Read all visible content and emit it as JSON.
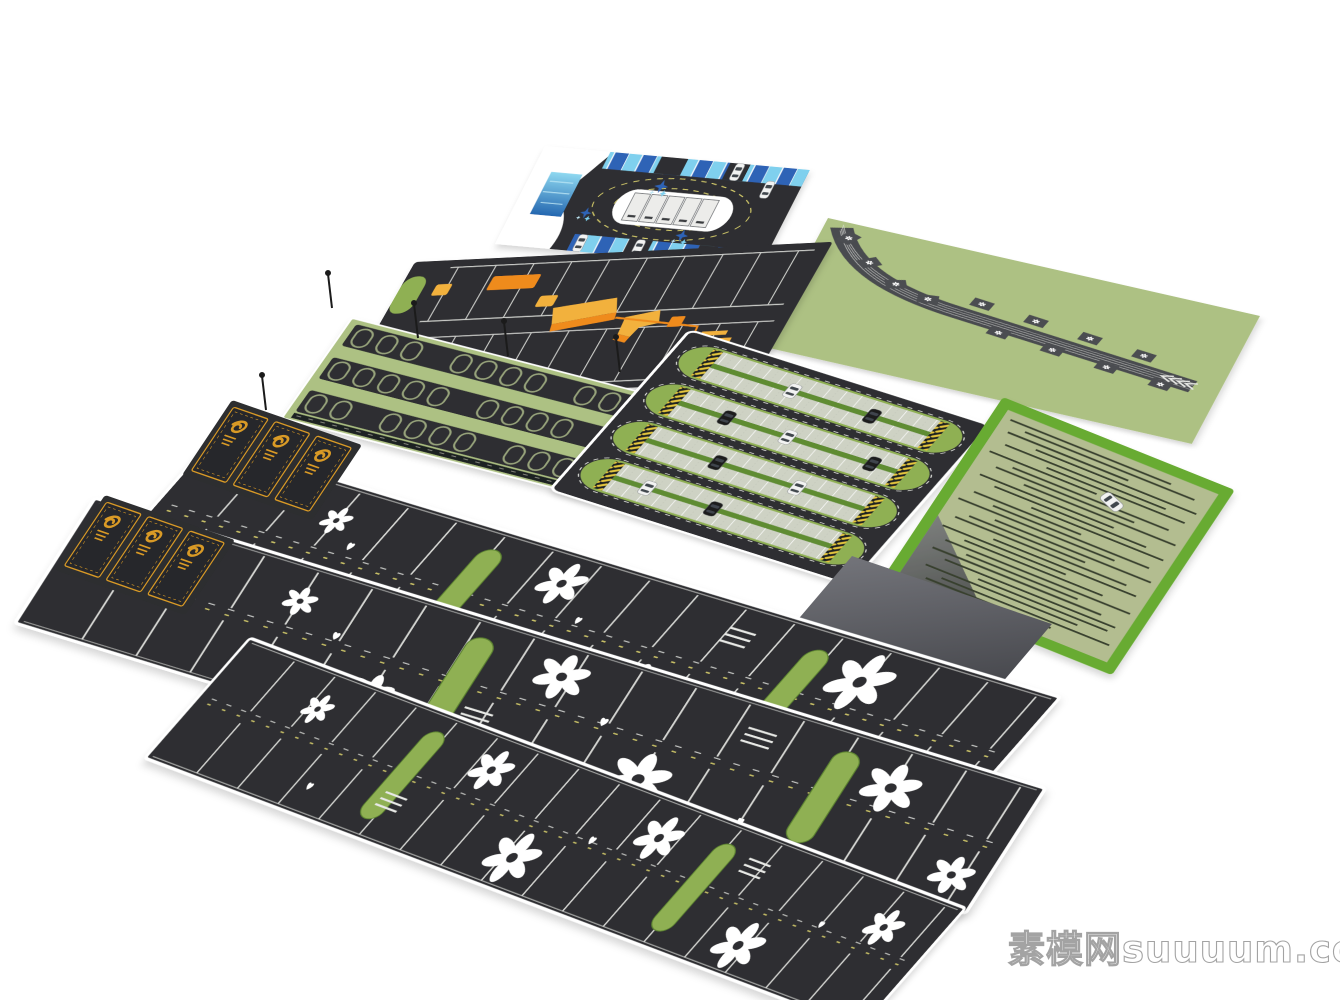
{
  "watermark": {
    "text": "素模网suuuum.com"
  },
  "palette": {
    "background": "#ffffff",
    "asphalt": "#2d2e30",
    "asphalt_deep": "#1f2022",
    "white": "#ffffff",
    "line_white": "#e8e9e6",
    "lawn": "#adc183",
    "lawn_bright": "#67ab33",
    "island_green": "#8fb052",
    "stall_gray": "#ced2c4",
    "blue_light": "#7fd0ee",
    "blue_dark": "#2e63b6",
    "orange": "#ef8b1e",
    "amber": "#f2b13d",
    "gold": "#d99a26",
    "road_gray": "#4c4d51",
    "paver_sage": "#b3bd90",
    "paver_outline": "#97a37b",
    "streak_green": "#39412f",
    "lane_yellow": "#d8cf6e",
    "water_top": "#8ed8f0",
    "water_bottom": "#2467b0",
    "ramp_light": "#73747a",
    "ramp_dark": "#3c3d42",
    "wm_gray": "#9a9a9a"
  },
  "icons": {
    "flower": "six-petal-daisy-marking",
    "heart": "heart-marking",
    "car": "car-top-view",
    "splash": "blue-paint-splash",
    "chevrons": "road-chevron-arrows",
    "flourish": "gold-vip-stall-ornament"
  },
  "modules": [
    {
      "id": "blue-loop-lot"
    },
    {
      "id": "orange-accent-lot"
    },
    {
      "id": "paver-stall-rows"
    },
    {
      "id": "gold-vip-stalls-upper"
    },
    {
      "id": "gold-vip-stalls-lower"
    },
    {
      "id": "flower-stall-band-1"
    },
    {
      "id": "flower-stall-band-2"
    },
    {
      "id": "flower-stall-band-3"
    },
    {
      "id": "oval-island-lot"
    },
    {
      "id": "curved-road-lawn-lot"
    },
    {
      "id": "grass-paver-field"
    },
    {
      "id": "gray-ramp"
    }
  ]
}
